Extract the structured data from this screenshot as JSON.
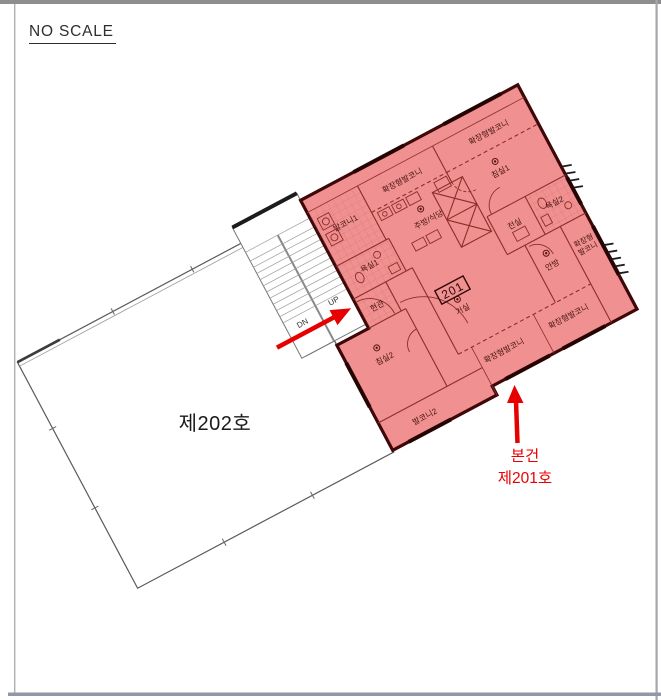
{
  "page": {
    "scale_note": "NO SCALE"
  },
  "plan": {
    "colors": {
      "highlight_fill": "#f09090",
      "outline_wall": "#3f0808",
      "inner_line": "#8f2c2c",
      "callout_red": "#e60000"
    },
    "unit201": {
      "number": "201",
      "rooms": {
        "balcony1": "발코니1",
        "kitchen_balcony": "확장형발코니",
        "kitchen": "주방/식당",
        "bath1": "욕실1",
        "entrance": "현관",
        "top_balcony": "확장형발코니",
        "bedroom1": "침실1",
        "bath2": "욕실2",
        "vestibule": "전실",
        "master_bedroom": "안방",
        "side_balcony_line1": "확장형",
        "side_balcony_line2": "발코니",
        "living": "거실",
        "bottom_balcony_left": "확장형발코니",
        "bottom_balcony_right": "확장형발코니",
        "bedroom2": "침실2",
        "balcony2": "발코니2"
      }
    },
    "unit202": {
      "label": "제202호"
    },
    "stairs": {
      "down": "DN",
      "up": "UP"
    },
    "callout": {
      "line1": "본건",
      "line2": "제201호"
    }
  }
}
